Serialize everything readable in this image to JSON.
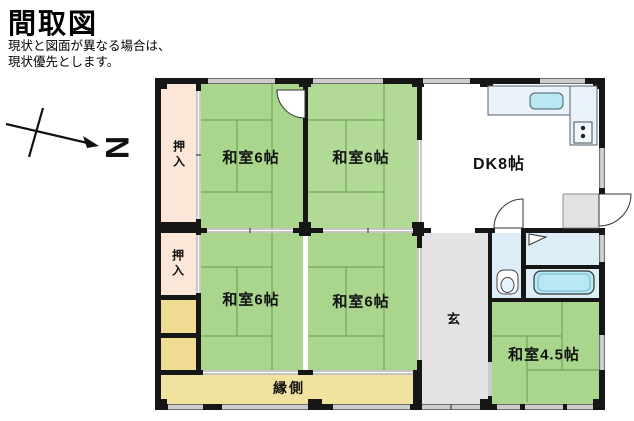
{
  "header": {
    "title": "間取図",
    "disclaimer": [
      "現状と図面が異なる場合は、",
      "現状優先とします。"
    ]
  },
  "compass": {
    "label": "N"
  },
  "rooms": {
    "oshiire1": {
      "label": "押入"
    },
    "oshiire2": {
      "label": "押入"
    },
    "washitsu1": {
      "label": "和室6帖"
    },
    "washitsu2": {
      "label": "和室6帖"
    },
    "washitsu3": {
      "label": "和室6帖"
    },
    "washitsu4": {
      "label": "和室6帖"
    },
    "dk": {
      "label": "DK8帖"
    },
    "genkan": {
      "label": "玄"
    },
    "washitsu45": {
      "label": "和室4.5帖"
    },
    "engawa": {
      "label": "縁側"
    }
  },
  "colors": {
    "tatami_green": "#a9d58d",
    "closet_pink": "#fbe6d8",
    "engawa_yellow": "#f2e2a0",
    "storage_yellow": "#efdc90",
    "genkan_gray": "#e3e3e3",
    "water_blue": "#ddeef8",
    "fixture_cyan": "#b9e8f4",
    "wall_black": "#161616"
  }
}
